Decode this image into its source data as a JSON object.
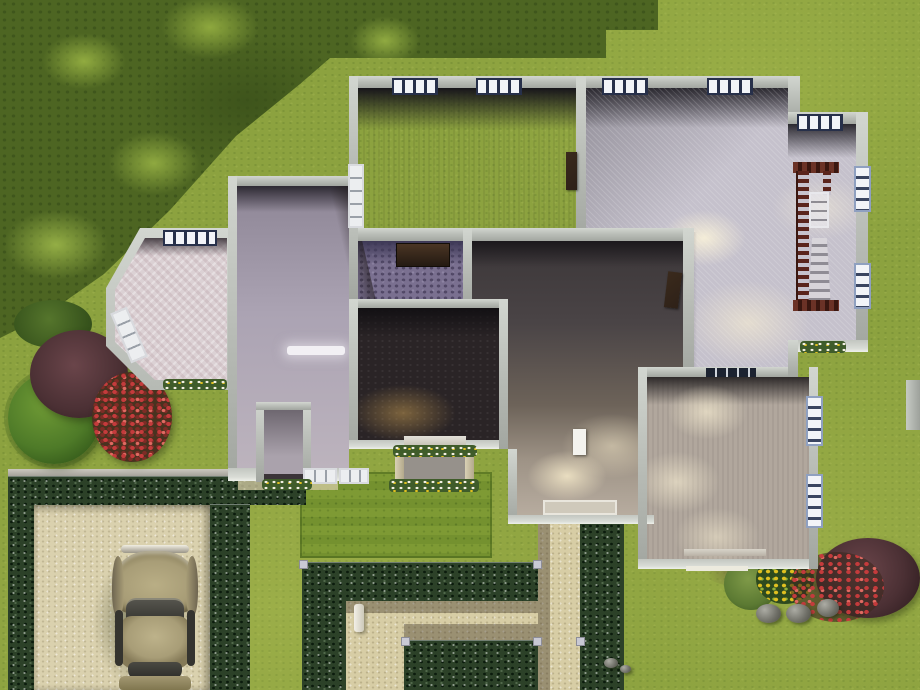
{
  "meta": {
    "description": "Top-down bird's-eye view of a suburban house lot in a life-simulation game (build/buy mode style), walls shown cut-away with visible room floors",
    "canvas": {
      "width": 920,
      "height": 690
    },
    "visible_text": "none"
  },
  "colors": {
    "grass": "#8ca23f",
    "grass_light": "#a9b556",
    "tree_shadow": "#4d6522",
    "lawn_patch": "#74912f",
    "hedge": "#2c4128",
    "path": "#d7cda5",
    "driveway": "#dad1ae",
    "fence": "#a5a29a",
    "wall": "#b6bab4",
    "wall_light": "#d2d6d0",
    "floor_bedroom_nw": "#6e6773",
    "floor_living": "#c5c1cc",
    "floor_bath": "#7a7090",
    "floor_dark_room": "#2a2426",
    "floor_hall_dark": "#453f41",
    "floor_hall_light": "#b7ac9f",
    "floor_bedroom_se": "#b1a79d",
    "floor_foyer": "#aba3b3",
    "floor_bay": "#dbd1d4",
    "stair_rail": "#5a241c",
    "stair_steps": "#d8d5da",
    "car_body": "#a89d77",
    "car_glass": "#35342f",
    "flowers_red": "#c43b3c",
    "flowers_yellow": "#e0c020",
    "bush_maroon": "#4b3034",
    "bush_green": "#4e7a28",
    "rock": "#8b8b85",
    "window_frame": "#27304a",
    "window_pane": "#f2f4f8",
    "door_wood": "#2e2118"
  },
  "house": {
    "rooms": [
      {
        "name": "bedroom-nw",
        "floor": "dark mauve-gray carpet",
        "windows_top": 2,
        "window_left_white": 1
      },
      {
        "name": "living-stair-room",
        "floor": "pale lavender carpet",
        "shape": "L with stepped NE notch",
        "windows": 5,
        "has_staircase": true
      },
      {
        "name": "bathroom-small",
        "floor": "purple patterned tile",
        "furniture": "dark wood dresser against north wall"
      },
      {
        "name": "dark-den",
        "floor": "near-black patterned carpet with warm lamp glow"
      },
      {
        "name": "hallway-porch",
        "floor": "dark taupe fading to lit porch, white open door, white porch step"
      },
      {
        "name": "bedroom-se",
        "floor": "taupe carpet with light pools",
        "windows_right": 2,
        "window_top_dark": 1
      },
      {
        "name": "foyer-west-room",
        "floor": "lavender-gray, ceiling light bar, entry vestibule box at south wall",
        "windows_bottom": 2
      },
      {
        "name": "bay-room",
        "floor": "pink-white herringbone",
        "shape": "angled bay protruding west",
        "windows": 2
      }
    ],
    "features": [
      {
        "name": "staircase",
        "desc": "dark red-brown rail ladder seen from above, gray steps descending"
      },
      {
        "name": "stair-void-window",
        "desc": "white window frame visible in stair opening"
      },
      {
        "name": "door-bedroom-divider",
        "material": "dark wood"
      },
      {
        "name": "door-hallway",
        "material": "dark wood, ajar"
      },
      {
        "name": "door-porch-white",
        "material": "white, open on porch"
      },
      {
        "name": "trellis-arbor",
        "desc": "flower-covered arbor with two posts at den south wall"
      },
      {
        "name": "flowerbeds",
        "count": 3
      }
    ]
  },
  "yard": {
    "tree_canopy": "large dark tree canopy shadow with light leaf clumps over NW corner; stepped building shadow along top edge",
    "driveway": {
      "surface": "beige concrete pad",
      "bordered_by": "dark flowering hedges with low gray fence line"
    },
    "car": {
      "type": "vintage sedan, top view, parked facing north",
      "color": "olive-tan"
    },
    "hedge_garden": {
      "desc": "zig-zag beige gravel walkways between dark hedge rows leading to porch",
      "posts": 6,
      "ornament": "small white garden column"
    },
    "lawn_patch": "darker mowed rectangle of grass by back wall",
    "plants": [
      {
        "name": "bush-green-west"
      },
      {
        "name": "bush-maroon-west"
      },
      {
        "name": "bush-red-flowers-west"
      },
      {
        "name": "shrub-green-se"
      },
      {
        "name": "flowers-yellow-se"
      },
      {
        "name": "bush-red-flowers-se"
      },
      {
        "name": "bush-maroon-se"
      }
    ],
    "rocks": {
      "large": 3,
      "pebbles": 2
    },
    "misc": [
      {
        "name": "gray-object-right-edge"
      }
    ]
  }
}
